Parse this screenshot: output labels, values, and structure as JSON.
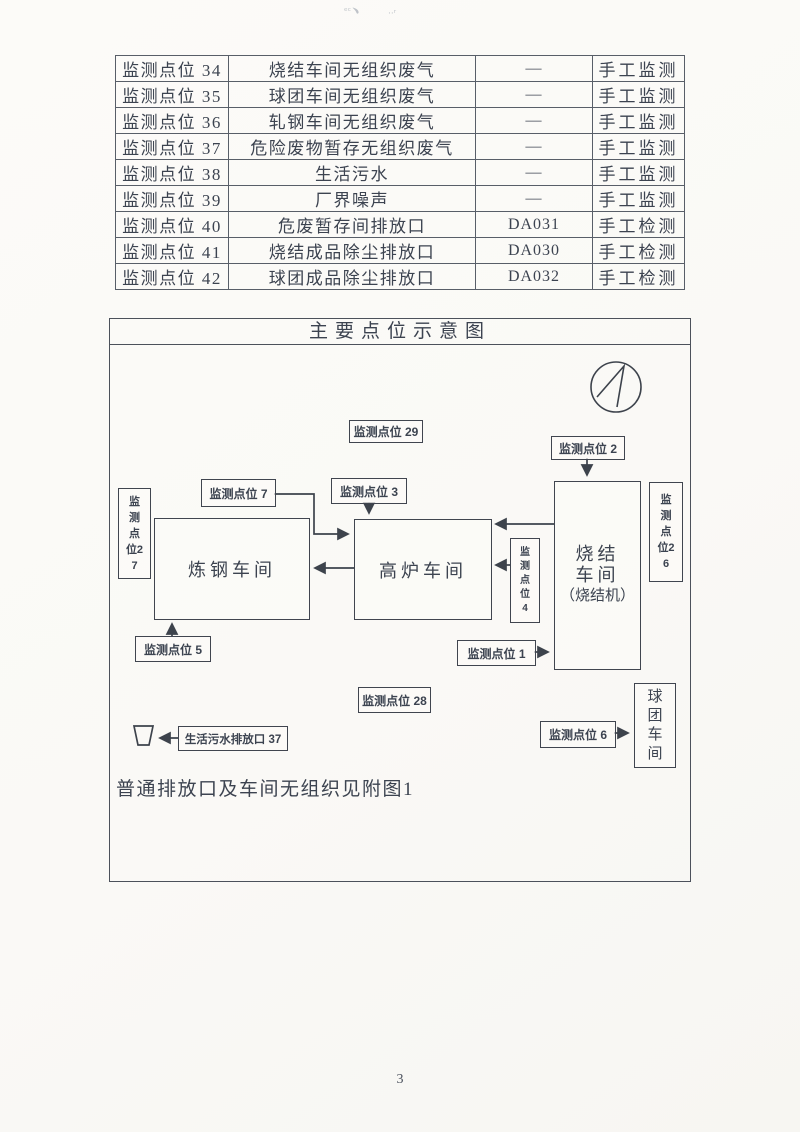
{
  "page": {
    "number": "3"
  },
  "table": {
    "rows": [
      {
        "point": "监测点位 34",
        "item": "烧结车间无组织废气",
        "code": "—",
        "method": "手工监测"
      },
      {
        "point": "监测点位 35",
        "item": "球团车间无组织废气",
        "code": "—",
        "method": "手工监测"
      },
      {
        "point": "监测点位 36",
        "item": "轧钢车间无组织废气",
        "code": "—",
        "method": "手工监测"
      },
      {
        "point": "监测点位 37",
        "item": "危险废物暂存无组织废气",
        "code": "—",
        "method": "手工监测"
      },
      {
        "point": "监测点位 38",
        "item": "生活污水",
        "code": "—",
        "method": "手工监测"
      },
      {
        "point": "监测点位 39",
        "item": "厂界噪声",
        "code": "—",
        "method": "手工监测"
      },
      {
        "point": "监测点位 40",
        "item": "危废暂存间排放口",
        "code": "DA031",
        "method": "手工检测"
      },
      {
        "point": "监测点位 41",
        "item": "烧结成品除尘排放口",
        "code": "DA030",
        "method": "手工检测"
      },
      {
        "point": "监测点位 42",
        "item": "球团成品除尘排放口",
        "code": "DA032",
        "method": "手工检测"
      }
    ]
  },
  "diagram": {
    "title": "主要点位示意图",
    "note": "普通排放口及车间无组织见附图1",
    "workshops": {
      "steelmaking": "炼钢车间",
      "blast_furnace": "高炉车间",
      "sintering_l1": "烧结",
      "sintering_l2": "车间",
      "sintering_l3": "（烧结机）",
      "pelletizing": "球团车间"
    },
    "labels": {
      "p29": "监测点位 29",
      "p2": "监测点位 2",
      "p7": "监测点位 7",
      "p3": "监测点位 3",
      "p27": "监测点位27",
      "p26": "监测点位26",
      "p4": "监测点位4",
      "p5": "监测点位 5",
      "p1": "监测点位 1",
      "p28": "监测点位 28",
      "p6": "监测点位 6",
      "sewage_outlet": "生活污水排放口 37"
    },
    "icons": {
      "north_arrow": "north-arrow-icon",
      "sewage_basin": "basin-icon"
    },
    "colors": {
      "ink": "#3c4350",
      "line": "#3d434c",
      "paper": "#fcfbf8"
    }
  }
}
